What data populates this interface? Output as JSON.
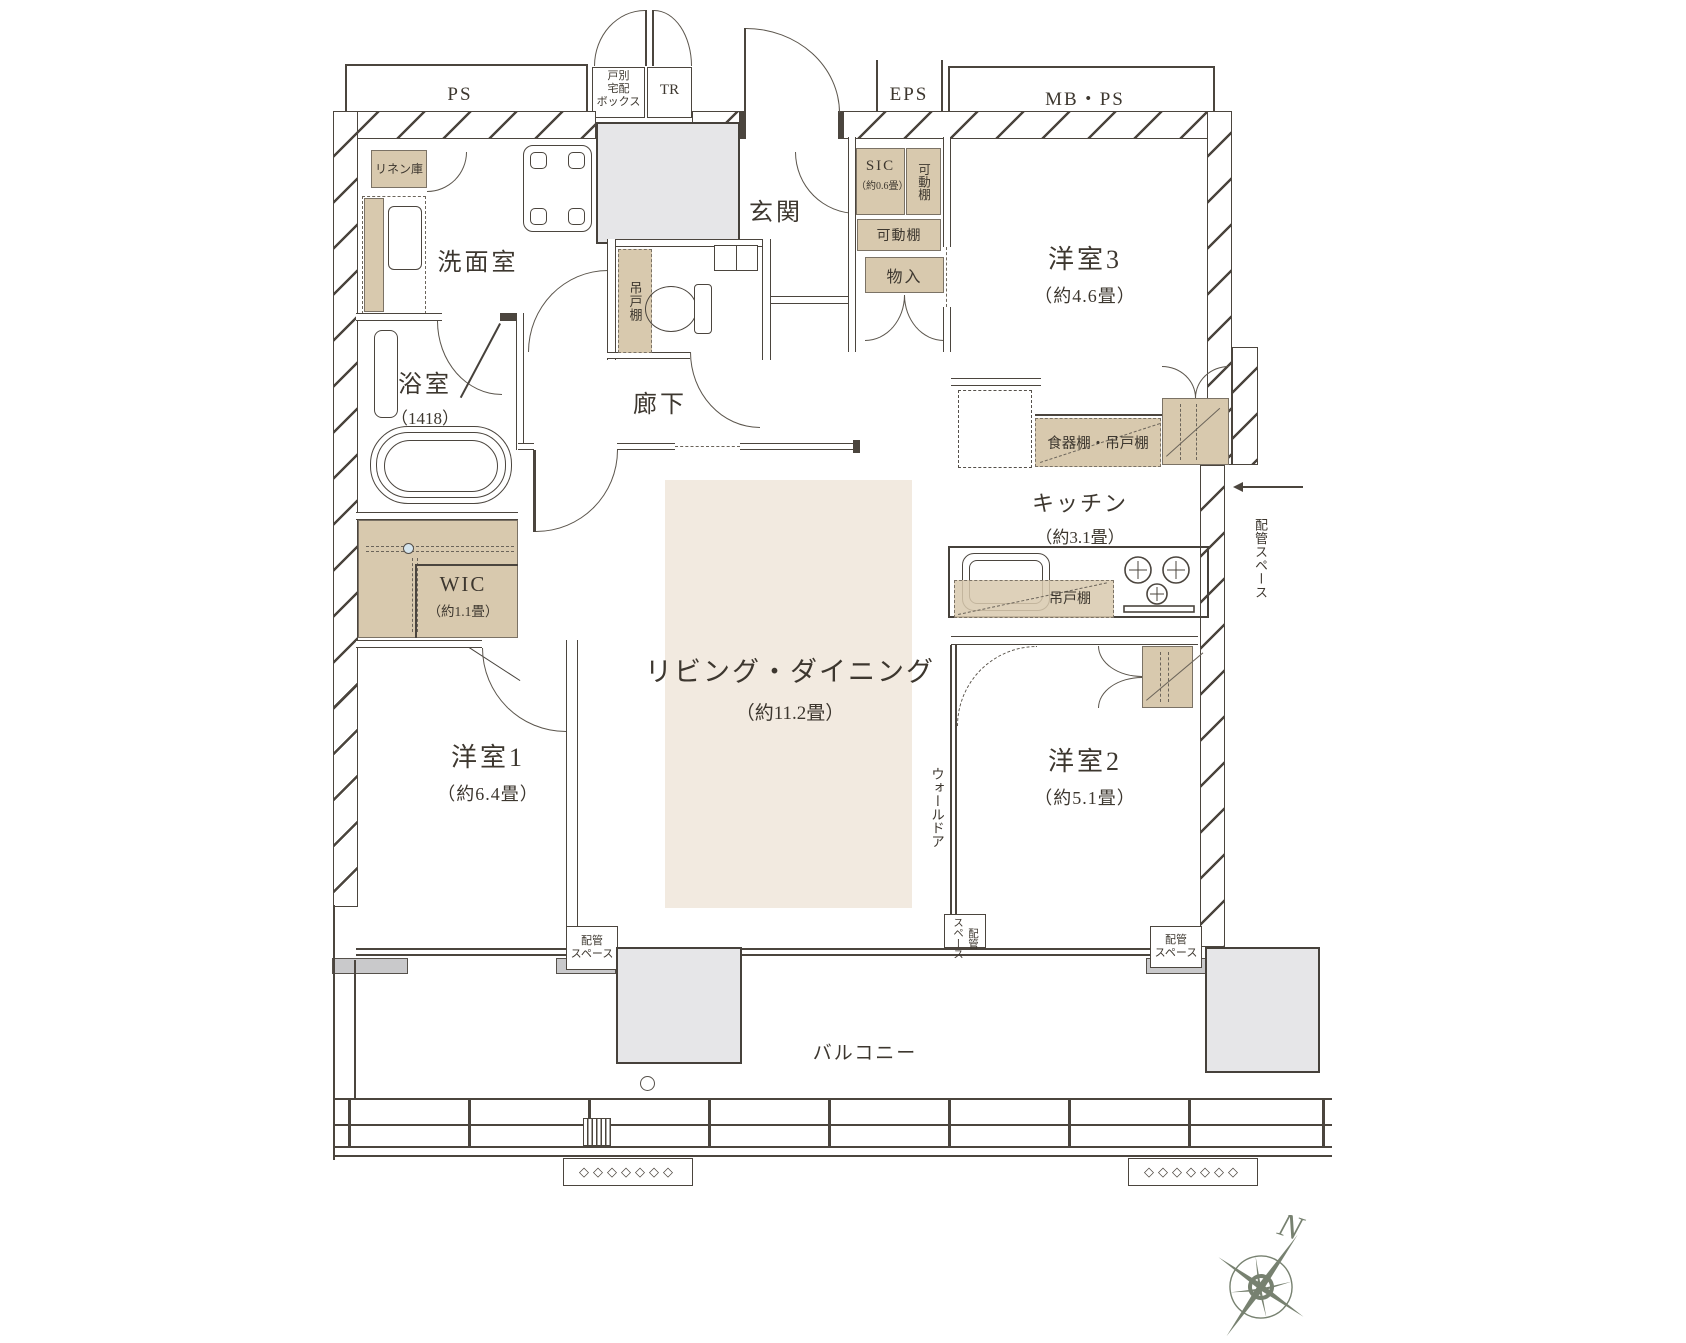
{
  "plan": {
    "title": "マンション間取り図",
    "shafts": {
      "ps": "PS",
      "delivery_box": "戸別\n宅配\nボックス",
      "tr": "TR",
      "eps": "EPS",
      "mbps": "MB・PS"
    },
    "rooms": {
      "entrance": {
        "label": "玄関"
      },
      "powder": {
        "label": "洗面室"
      },
      "bath": {
        "label": "浴室",
        "size": "（1418）"
      },
      "wic": {
        "label": "WIC",
        "size": "（約1.1畳）"
      },
      "bed1": {
        "label": "洋室1",
        "size": "（約6.4畳）"
      },
      "bed2": {
        "label": "洋室2",
        "size": "（約5.1畳）"
      },
      "bed3": {
        "label": "洋室3",
        "size": "（約4.6畳）"
      },
      "living": {
        "label": "リビング・ダイニング",
        "size": "（約11.2畳）"
      },
      "kitchen": {
        "label": "キッチン",
        "size": "（約3.1畳）"
      },
      "hall": {
        "label": "廊下"
      },
      "sic": {
        "label": "SIC",
        "size": "（約0.6畳）"
      },
      "balcony": {
        "label": "バルコニー"
      }
    },
    "storage": {
      "linen": "リネン庫",
      "movable_shelf_1": "可動棚",
      "movable_shelf_2": "可動棚",
      "closet_small": "物入",
      "hanging_shelf_toilet": "吊戸棚",
      "dish_hanging_shelf": "食器棚・吊戸棚",
      "hanging_shelf_kitchen": "吊戸棚",
      "wall_door": "ウォールドア",
      "pipe_space_kitchen": "配管スペース",
      "pipe_space_bottom_left": "配管\nスペース",
      "pipe_space_bottom_mid": "配管\nスペース",
      "pipe_space_bottom_right": "配管\nスペース"
    },
    "compass": {
      "north": "N"
    },
    "decor": {
      "vent_glyphs": "◇◇◇◇◇◇◇"
    },
    "colors": {
      "wall_line": "#4b453e",
      "storage_fill": "#d8c9ae",
      "living_floor": "#f2eae0",
      "gray_box": "#e6e6e8",
      "sill": "#c9c9cb",
      "compass": "#778170"
    }
  }
}
